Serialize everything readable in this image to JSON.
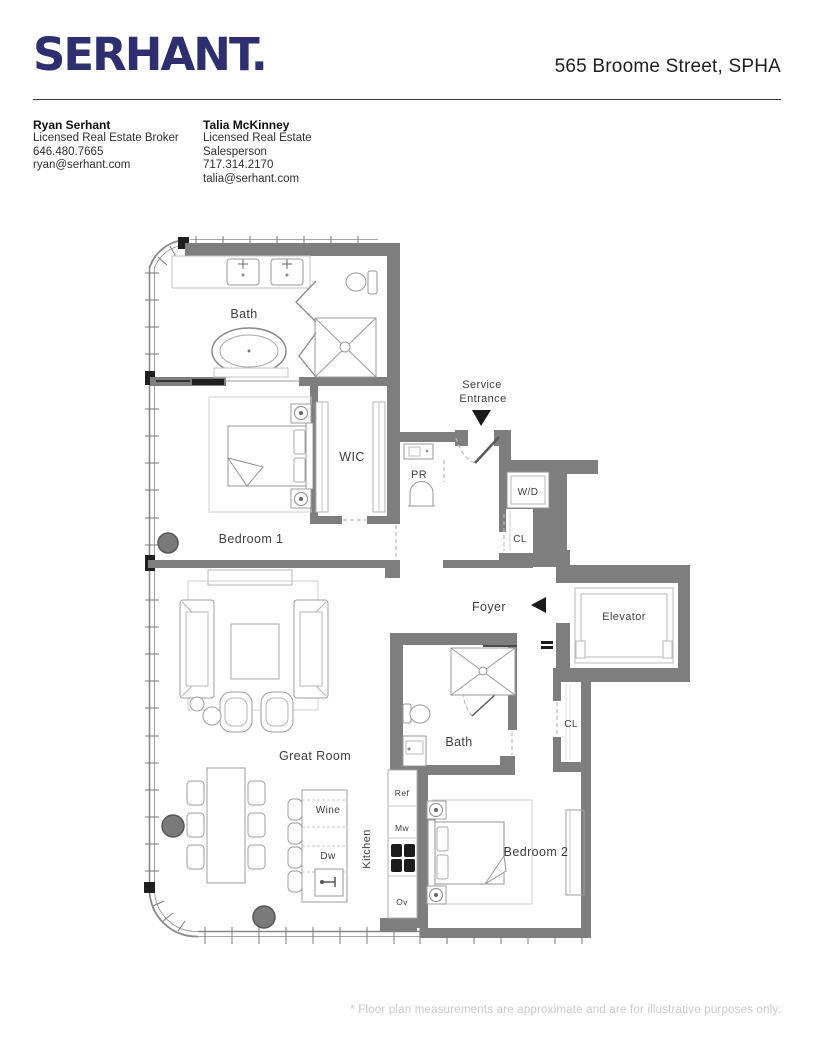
{
  "header": {
    "logo": "SERHANT.",
    "address": "565 Broome Street, SPHA"
  },
  "agents": [
    {
      "name": "Ryan Serhant",
      "title": "Licensed Real Estate Broker",
      "phone": "646.480.7665",
      "email": "ryan@serhant.com"
    },
    {
      "name": "Talia McKinney",
      "title": "Licensed Real Estate Salesperson",
      "phone": "717.314.2170",
      "email": "talia@serhant.com"
    }
  ],
  "floorplan": {
    "rooms": {
      "bath1": "Bath",
      "wic": "WIC",
      "pr": "PR",
      "bedroom1": "Bedroom 1",
      "wd": "W/D",
      "cl1": "CL",
      "foyer": "Foyer",
      "elevator": "Elevator",
      "bath2": "Bath",
      "cl2": "CL",
      "great_room": "Great Room",
      "kitchen": "Kitchen",
      "bedroom2": "Bedroom 2"
    },
    "appliances": {
      "wine": "Wine",
      "dw": "Dw",
      "ref": "Ref",
      "mw": "Mw",
      "ov": "Ov"
    },
    "annotations": {
      "service_line1": "Service",
      "service_line2": "Entrance"
    }
  },
  "footer": {
    "disclaimer": "* Floor plan measurements are approximate and are for illustrative purposes only."
  },
  "colors": {
    "brand_navy": "#2d2f6e",
    "wall_gray": "#7e7e7e",
    "text_dark": "#1f1f1f",
    "label_gray": "#3d3d3d",
    "footer_gray": "#c9c9c9"
  }
}
